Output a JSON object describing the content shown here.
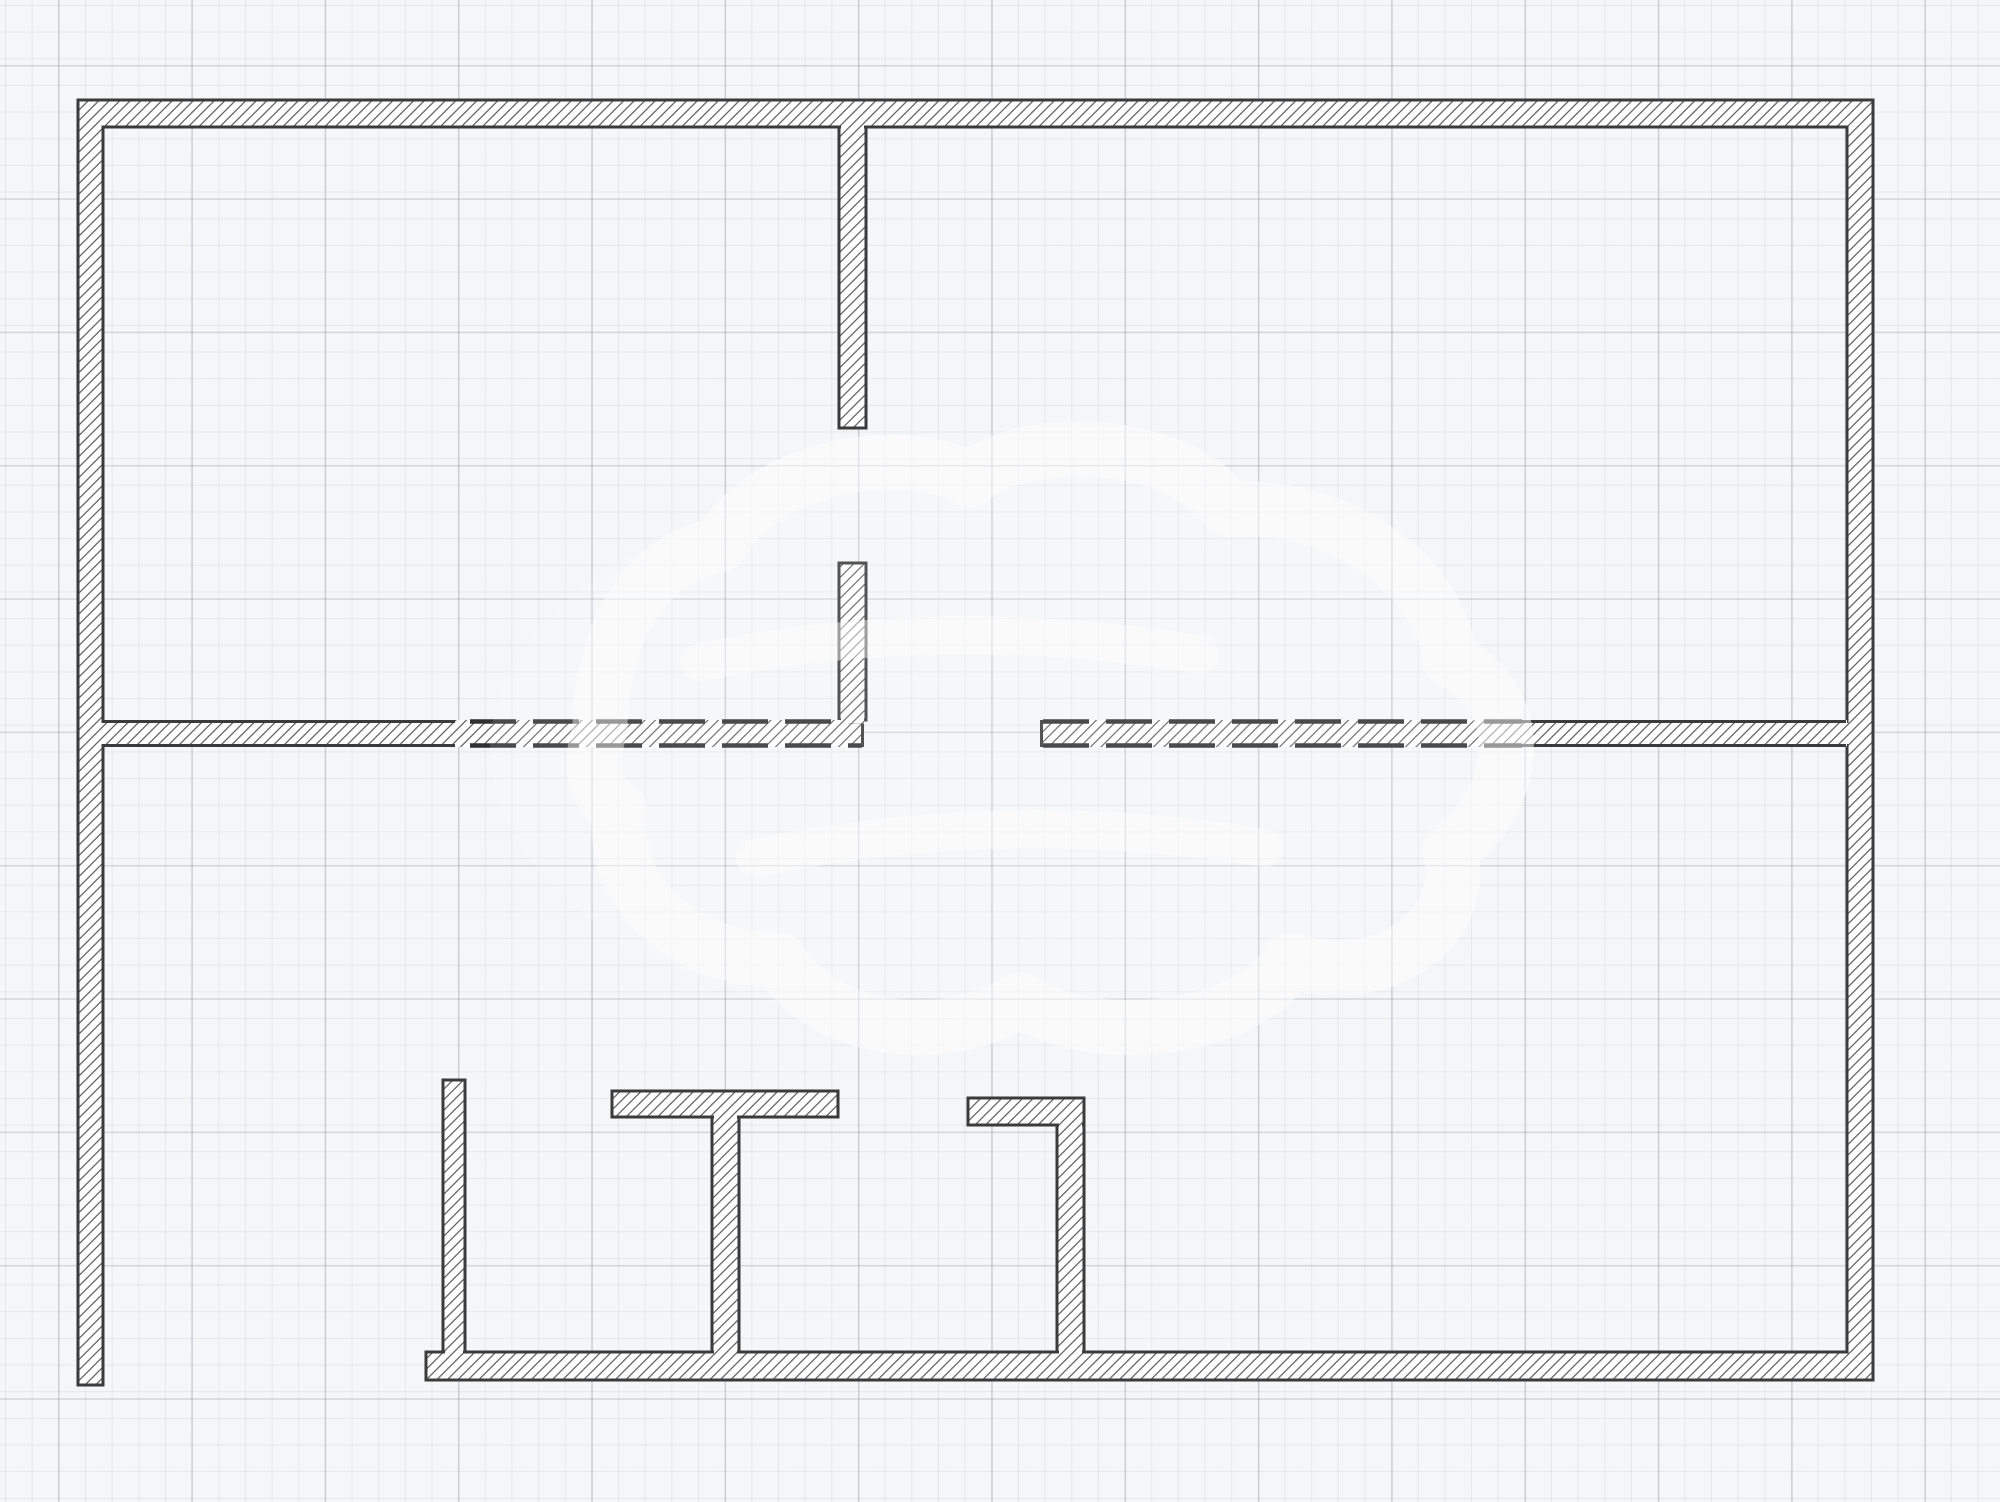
{
  "canvas": {
    "width": 2000,
    "height": 1502,
    "background": "#f5f6f7"
  },
  "grid": {
    "minor_spacing_px": 26.667,
    "major_spacing_px": 133.33,
    "minor_color": "rgba(120,132,144,0.12)",
    "major_color": "rgba(110,122,134,0.26)"
  },
  "style": {
    "wall_fill": "#ffffff",
    "wall_outline_color": "#3b3b3b",
    "wall_outline_width": 3,
    "hatch_color": "#626466",
    "hatch_spacing": 10.5,
    "hatch_line_width": 1.3,
    "dash_color": "#303030",
    "dash_line_width": 4.5,
    "dash_array": "46 17",
    "watermark_white": "rgba(255,255,255,1)",
    "watermark_opacity": 0.5
  },
  "floorplan": {
    "outer_walls": {
      "name": "outer-walls",
      "path": "M78,100 H1873 V1380 H426 V1352 H1847 V127 H103 V1385 H78 Z"
    },
    "stroked_walls": [
      {
        "name": "partition-upper",
        "x": 839,
        "y": 127,
        "w": 27,
        "h": 301
      },
      {
        "name": "partition-lower",
        "x": 839,
        "y": 563,
        "w": 27,
        "h": 157
      },
      {
        "name": "closet-wall-left",
        "x": 443,
        "y": 1080,
        "w": 22,
        "h": 272
      },
      {
        "name": "t-wall-cap",
        "x": 612,
        "y": 1091,
        "w": 226,
        "h": 26
      },
      {
        "name": "t-wall-stem",
        "x": 712,
        "y": 1117,
        "w": 27,
        "h": 235
      },
      {
        "name": "corner-wall-cap",
        "x": 968,
        "y": 1098,
        "w": 116,
        "h": 27
      },
      {
        "name": "corner-wall-stem",
        "x": 1057,
        "y": 1125,
        "w": 27,
        "h": 227
      }
    ],
    "fill_walls": [
      {
        "name": "middle-wall-left-fill",
        "x": 103,
        "y": 720,
        "w": 761,
        "h": 27
      },
      {
        "name": "middle-wall-right-fill",
        "x": 1040,
        "y": 720,
        "w": 807,
        "h": 27
      }
    ],
    "edges": [
      {
        "name": "middle-left-top-solid",
        "x1": 103,
        "y1": 721.5,
        "x2": 455,
        "y2": 721.5,
        "dashed": false
      },
      {
        "name": "middle-left-top-dashed",
        "x1": 470,
        "y1": 721.5,
        "x2": 862,
        "y2": 721.5,
        "dashed": true
      },
      {
        "name": "middle-left-bottom-solid",
        "x1": 103,
        "y1": 745.5,
        "x2": 455,
        "y2": 745.5,
        "dashed": false
      },
      {
        "name": "middle-left-bottom-dashed",
        "x1": 470,
        "y1": 745.5,
        "x2": 862,
        "y2": 745.5,
        "dashed": true
      },
      {
        "name": "middle-right-top-dashed",
        "x1": 1043,
        "y1": 721.5,
        "x2": 1522,
        "y2": 721.5,
        "dashed": true
      },
      {
        "name": "middle-right-top-solid",
        "x1": 1522,
        "y1": 721.5,
        "x2": 1846,
        "y2": 721.5,
        "dashed": false
      },
      {
        "name": "middle-right-bottom-dashed",
        "x1": 1043,
        "y1": 745.5,
        "x2": 1522,
        "y2": 745.5,
        "dashed": true
      },
      {
        "name": "middle-right-bottom-solid",
        "x1": 1522,
        "y1": 745.5,
        "x2": 1846,
        "y2": 745.5,
        "dashed": false
      }
    ],
    "caps": [
      {
        "name": "middle-left-end-cap",
        "x1": 862.5,
        "y1": 720,
        "x2": 862.5,
        "y2": 747
      },
      {
        "name": "middle-right-start-cap",
        "x1": 1041.5,
        "y1": 720,
        "x2": 1041.5,
        "y2": 747
      }
    ],
    "patches": [
      {
        "name": "junction-partition-topwall",
        "x": 841,
        "y": 123.5,
        "w": 23,
        "h": 7.5
      },
      {
        "name": "junction-partition-middlewall",
        "x": 841,
        "y": 716.5,
        "w": 23,
        "h": 7
      },
      {
        "name": "junction-middleleft-leftwall",
        "x": 100.8,
        "y": 723,
        "w": 5.5,
        "h": 21
      },
      {
        "name": "junction-middleright-rightwall",
        "x": 1844,
        "y": 723,
        "w": 5.5,
        "h": 21
      },
      {
        "name": "junction-tcap-tstem",
        "x": 714,
        "y": 1113.5,
        "w": 23,
        "h": 7
      },
      {
        "name": "junction-tstem-bottomwall",
        "x": 714,
        "y": 1348.5,
        "w": 23,
        "h": 7
      },
      {
        "name": "junction-closet-bottomwall",
        "x": 445,
        "y": 1348.5,
        "w": 18,
        "h": 7
      },
      {
        "name": "junction-cornercap-stem",
        "x": 1059,
        "y": 1121.5,
        "w": 23,
        "h": 7
      },
      {
        "name": "junction-cornerstem-bottomwall",
        "x": 1059,
        "y": 1348.5,
        "w": 23,
        "h": 7
      }
    ]
  },
  "watermark": {
    "name": "cloud-watermark",
    "ellipse": {
      "cx": 990,
      "cy": 750,
      "rx": 500,
      "ry": 280,
      "fill": "rgba(255,255,255,0.25)"
    },
    "paths": [
      {
        "name": "cloud-outline",
        "width": 55,
        "d": "M600,730 C600,640 640,560 720,545 C760,470 900,440 970,480 C1030,430 1180,440 1230,510 C1330,500 1440,570 1450,660 C1530,700 1520,800 1450,850 C1470,930 1380,990 1290,960 C1250,1030 1100,1050 1020,1000 C940,1050 820,1030 780,960 C680,960 610,890 620,810 C590,790 590,760 600,730 Z"
      },
      {
        "name": "swoosh-upper",
        "width": 38,
        "d": "M700,662 Q950,612 1200,655"
      },
      {
        "name": "swoosh-lower",
        "width": 38,
        "d": "M755,858 Q1010,806 1265,848"
      }
    ]
  }
}
